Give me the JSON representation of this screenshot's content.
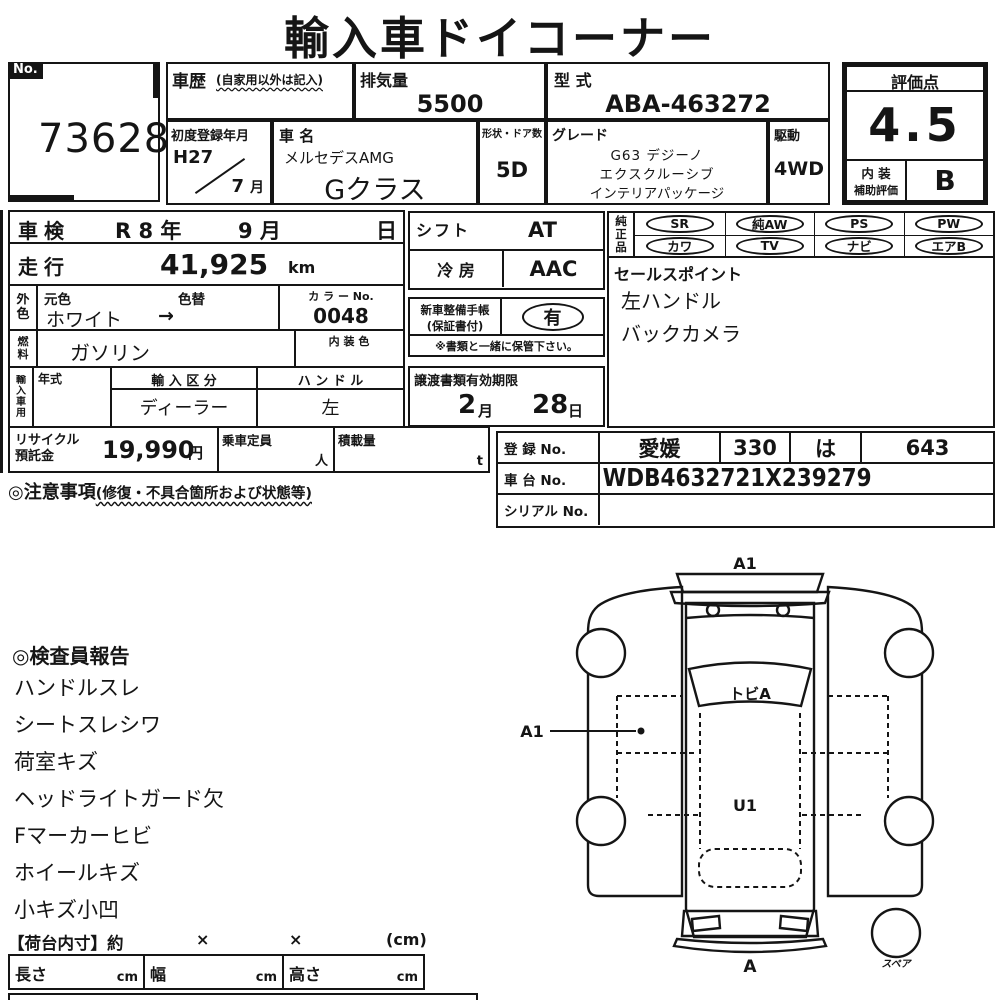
{
  "title": "輸入車ドイコーナー",
  "no_box": {
    "label": "No.",
    "value": "73628"
  },
  "header": {
    "shareki_label": "車歴",
    "shareki_note": "(自家用以外は記入)",
    "haikiryo_label": "排気量",
    "haikiryo_value": "5500",
    "katashiki_label": "型 式",
    "katashiki_value": "ABA-463272",
    "shodo_label": "初度登録年月",
    "shodo_year": "H27",
    "shodo_month": "7",
    "shodo_month_unit": "月",
    "shamei_label": "車 名",
    "shamei_line1": "メルセデスAMG",
    "shamei_line2": "Gクラス",
    "keijo_label": "形状・ドア数",
    "keijo_value": "5D",
    "grade_label": "グレード",
    "grade_lines": [
      "G63 デジーノ",
      "エクスクルーシブ",
      "インテリアパッケージ"
    ],
    "kudo_label": "駆動",
    "kudo_value": "4WD"
  },
  "hyoka": {
    "label": "評価点",
    "score": "4.5",
    "naiso_line1": "内 装",
    "naiso_line2": "補助評価",
    "naiso_grade": "B"
  },
  "spec": {
    "shaken_label": "車検",
    "shaken_year": "R 8 年",
    "shaken_month": "9 月",
    "shaken_day": "日",
    "soko_label": "走行",
    "soko_value": "41,925",
    "soko_unit": "km",
    "gaishoku_label": "外色",
    "motoiro_label": "元色",
    "irogae_label": "色替",
    "gaishoku_value": "ホワイト",
    "gaishoku_arrow": "→",
    "colorno_label": "カ ラ ー No.",
    "colorno_value": "0048",
    "nenryo_label": "燃料",
    "nenryo_value": "ガソリン",
    "naisoshoku_label": "内 装 色",
    "naisoshoku_value": "",
    "yunyu_label": "輸入車用",
    "nenshiki_label": "年式",
    "nenshiki_value": "",
    "kubun_label": "輸 入 区 分",
    "kubun_value": "ディーラー",
    "handle_label": "ハ ン ド ル",
    "handle_value": "左",
    "shift_label": "シフト",
    "shift_value": "AT",
    "reibo_label": "冷 房",
    "reibo_value": "AAC",
    "seibi_label1": "新車整備手帳",
    "seibi_label2": "(保証書付)",
    "seibi_value": "有",
    "seibi_note": "※書類と一緒に保管下さい。",
    "joto_label": "譲渡書類有効期限",
    "joto_month": "2",
    "joto_month_unit": "月",
    "joto_day": "28",
    "joto_day_unit": "日",
    "junsei_label": "純正品",
    "junsei_row1": [
      "SR",
      "純AW",
      "PS",
      "PW"
    ],
    "junsei_row2": [
      "カワ",
      "TV",
      "ナビ",
      "エアB"
    ],
    "sales_label": "セールスポイント",
    "sales_points": [
      "左ハンドル",
      "バックカメラ"
    ],
    "recycle_label1": "リサイクル",
    "recycle_label2": "預託金",
    "recycle_value": "19,990",
    "recycle_unit": "円",
    "teiin_label": "乗車定員",
    "teiin_unit": "人",
    "sekisai_label": "積載量",
    "sekisai_unit": "t",
    "chui_label": "◎注意事項",
    "chui_note": "(修復・不具合箇所および状態等)"
  },
  "registration": {
    "toroku_label": "登 録 No.",
    "toroku_values": [
      "愛媛",
      "330",
      "は",
      "643"
    ],
    "shadai_label": "車 台 No.",
    "shadai_value": "WDB4632721X239279",
    "serial_label": "シリアル No.",
    "serial_value": ""
  },
  "inspector": {
    "heading": "◎検査員報告",
    "items": [
      "ハンドルスレ",
      "シートスレシワ",
      "荷室キズ",
      "ヘッドライトガード欠",
      "Fマーカーヒビ",
      "ホイールキズ",
      "小キズ小凹"
    ]
  },
  "diagram": {
    "front_label": "A1",
    "windshield_label": "トビA",
    "door_label": "A1",
    "roof_label": "U1",
    "rear_label": "A",
    "spare_label": "スペア"
  },
  "cargo": {
    "title": "【荷台内寸】約",
    "times1": "×",
    "times2": "×",
    "unit": "(cm)",
    "cols": [
      {
        "label": "長さ",
        "unit": "cm"
      },
      {
        "label": "幅",
        "unit": "cm"
      },
      {
        "label": "高さ",
        "unit": "cm"
      }
    ]
  }
}
